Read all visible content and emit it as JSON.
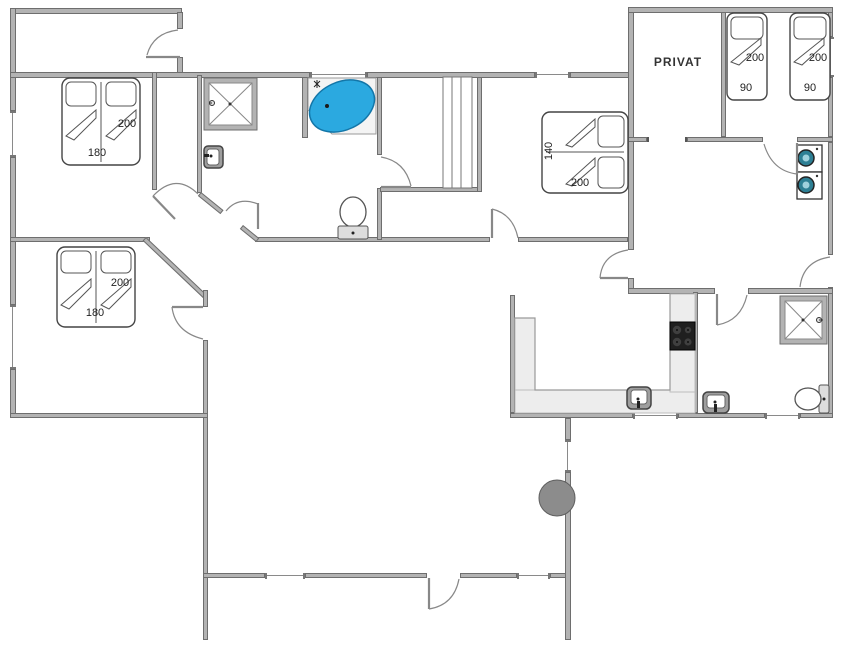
{
  "rooms": {
    "privat": "PRIVAT"
  },
  "beds": {
    "bedroom1": {
      "length": "200",
      "width": "180"
    },
    "bedroom2": {
      "length": "200",
      "width": "180"
    },
    "bedroom3": {
      "length": "200",
      "width": "140"
    },
    "single1": {
      "length": "200",
      "width": "90"
    },
    "single2": {
      "length": "200",
      "width": "90"
    }
  },
  "icons": {
    "corner-bathtub": "blue water oval",
    "shower-cabin": "square with X",
    "toilet": "oval bowl with cistern",
    "sink": "rounded square with tap",
    "stove-cooktop": "black square with 4 burners",
    "washer-dryer-stack": "two units with round doors",
    "wood-stove": "gray circle on flue",
    "wardrobe": "rect with sliding panels"
  },
  "colors": {
    "wall": "#b3b3b3",
    "wall-border": "#6e6e6e",
    "water": "#2BA9E0",
    "water-border": "#1376A8",
    "counter": "#ededed",
    "stove": "#1f1f1f",
    "appliance": "#2d7f94",
    "fireplace": "#8c8c8c"
  }
}
